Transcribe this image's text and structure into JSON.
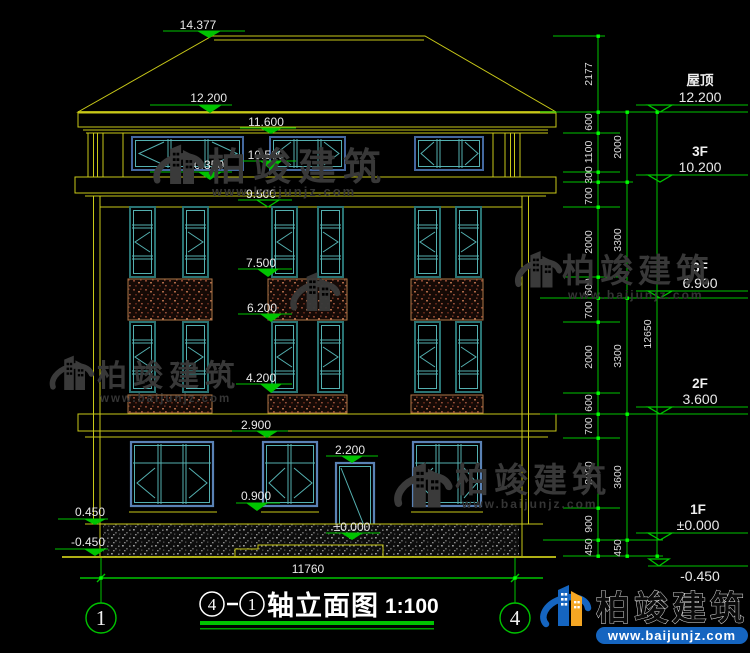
{
  "title_block": {
    "axis_start": "4",
    "axis_end": "1",
    "name": "轴立面图",
    "scale": "1:100"
  },
  "axis_bubbles": {
    "left": "1",
    "right": "4"
  },
  "overall_width_dim": "11760",
  "left_markers": {
    "eave": "12.200",
    "band": "10.350",
    "plinth": "0.450",
    "ground": "-0.450"
  },
  "mid_markers": {
    "ridge": "14.377",
    "soffit": "11.600",
    "attic_sill": "10.500",
    "wall_top": "9.500",
    "f3_sill": "7.500",
    "f2_head": "6.200",
    "f2_sill": "4.200",
    "belt": "2.900",
    "door_head": "2.200",
    "f1_sill": "0.900",
    "zero": "±0.000"
  },
  "right_levels": [
    {
      "label": "屋顶",
      "value": "12.200"
    },
    {
      "label": "3F",
      "value": "10.200"
    },
    {
      "label": "3F",
      "value": "6.900"
    },
    {
      "label": "2F",
      "value": "3.600"
    },
    {
      "label": "1F",
      "value": "±0.000"
    },
    {
      "label": "",
      "value": "-0.450"
    }
  ],
  "dims": {
    "chain_a": [
      "2177",
      "600",
      "1100",
      "300",
      "700",
      "2000",
      "600",
      "700",
      "2000",
      "600",
      "700",
      "2000",
      "900",
      "450"
    ],
    "chain_b": [
      "2000",
      "3300",
      "3300",
      "3600",
      "450"
    ],
    "chain_c": [
      "12650"
    ]
  },
  "watermark": {
    "brand": "柏竣建筑",
    "url": "www.baijunjz.com"
  },
  "footer_logo": {
    "brand": "柏竣建筑",
    "url": "www.baijunjz.com"
  },
  "colors": {
    "dim_green": "#00c400",
    "outline_yellow": "#c8c818",
    "logo_blue": "#1565c0",
    "logo_orange": "#f5a623"
  }
}
